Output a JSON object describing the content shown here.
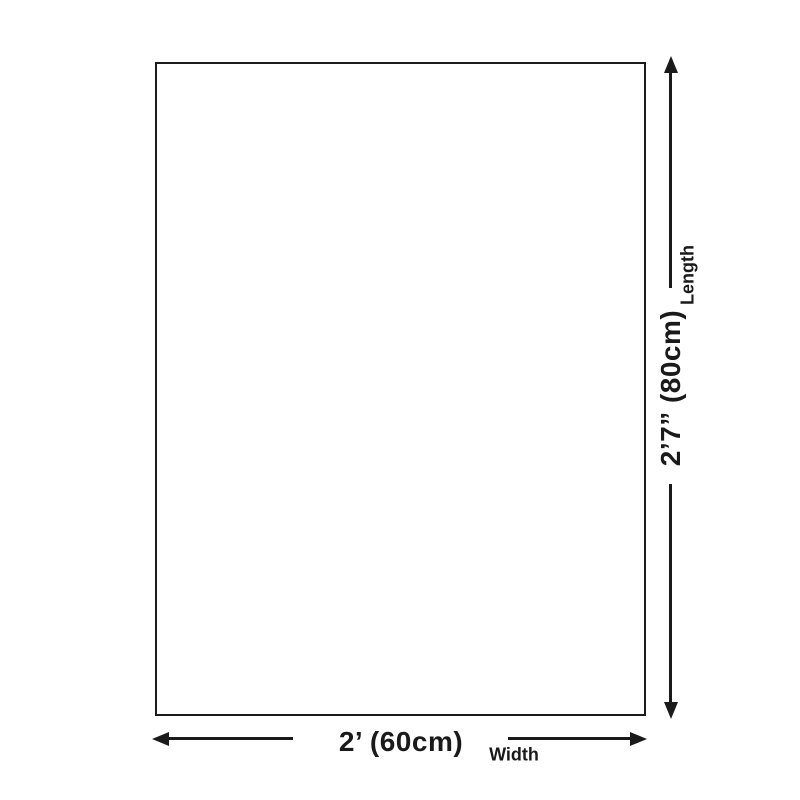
{
  "diagram": {
    "background": "#ffffff",
    "line_color": "#1a1a1a",
    "rect_border_color": "#1c1c1c",
    "length": {
      "value": "2’7” (80cm)",
      "label": "Length"
    },
    "width": {
      "value": "2’ (60cm)",
      "label": "Width"
    }
  }
}
